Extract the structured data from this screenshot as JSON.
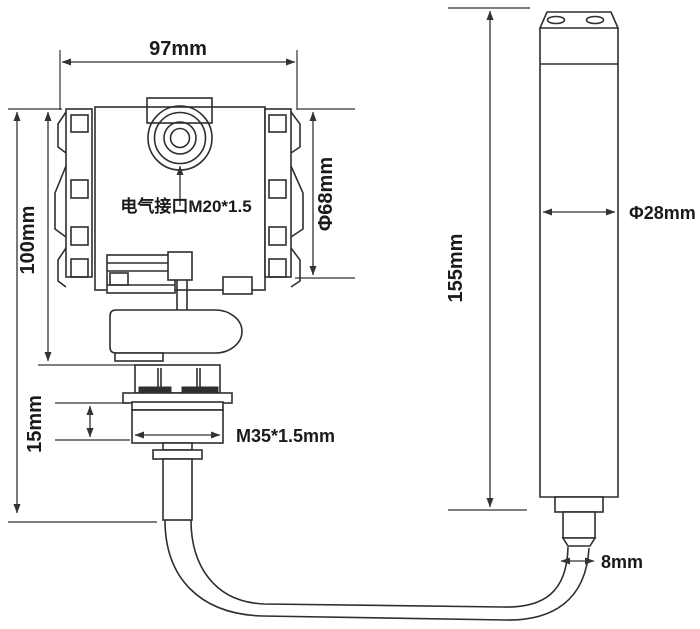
{
  "colors": {
    "line": "#2f2f2f",
    "dimension": "#333333",
    "text": "#1a1a1a",
    "background": "#ffffff"
  },
  "drawing": {
    "labels": {
      "housing_width": "97mm",
      "housing_height": "100mm",
      "housing_diameter": "Φ68mm",
      "electrical_interface": "电气接口M20*1.5",
      "thread_height": "15mm",
      "thread_spec": "M35*1.5mm",
      "probe_length": "155mm",
      "probe_diameter": "Φ28mm",
      "cable_diameter": "8mm"
    }
  }
}
